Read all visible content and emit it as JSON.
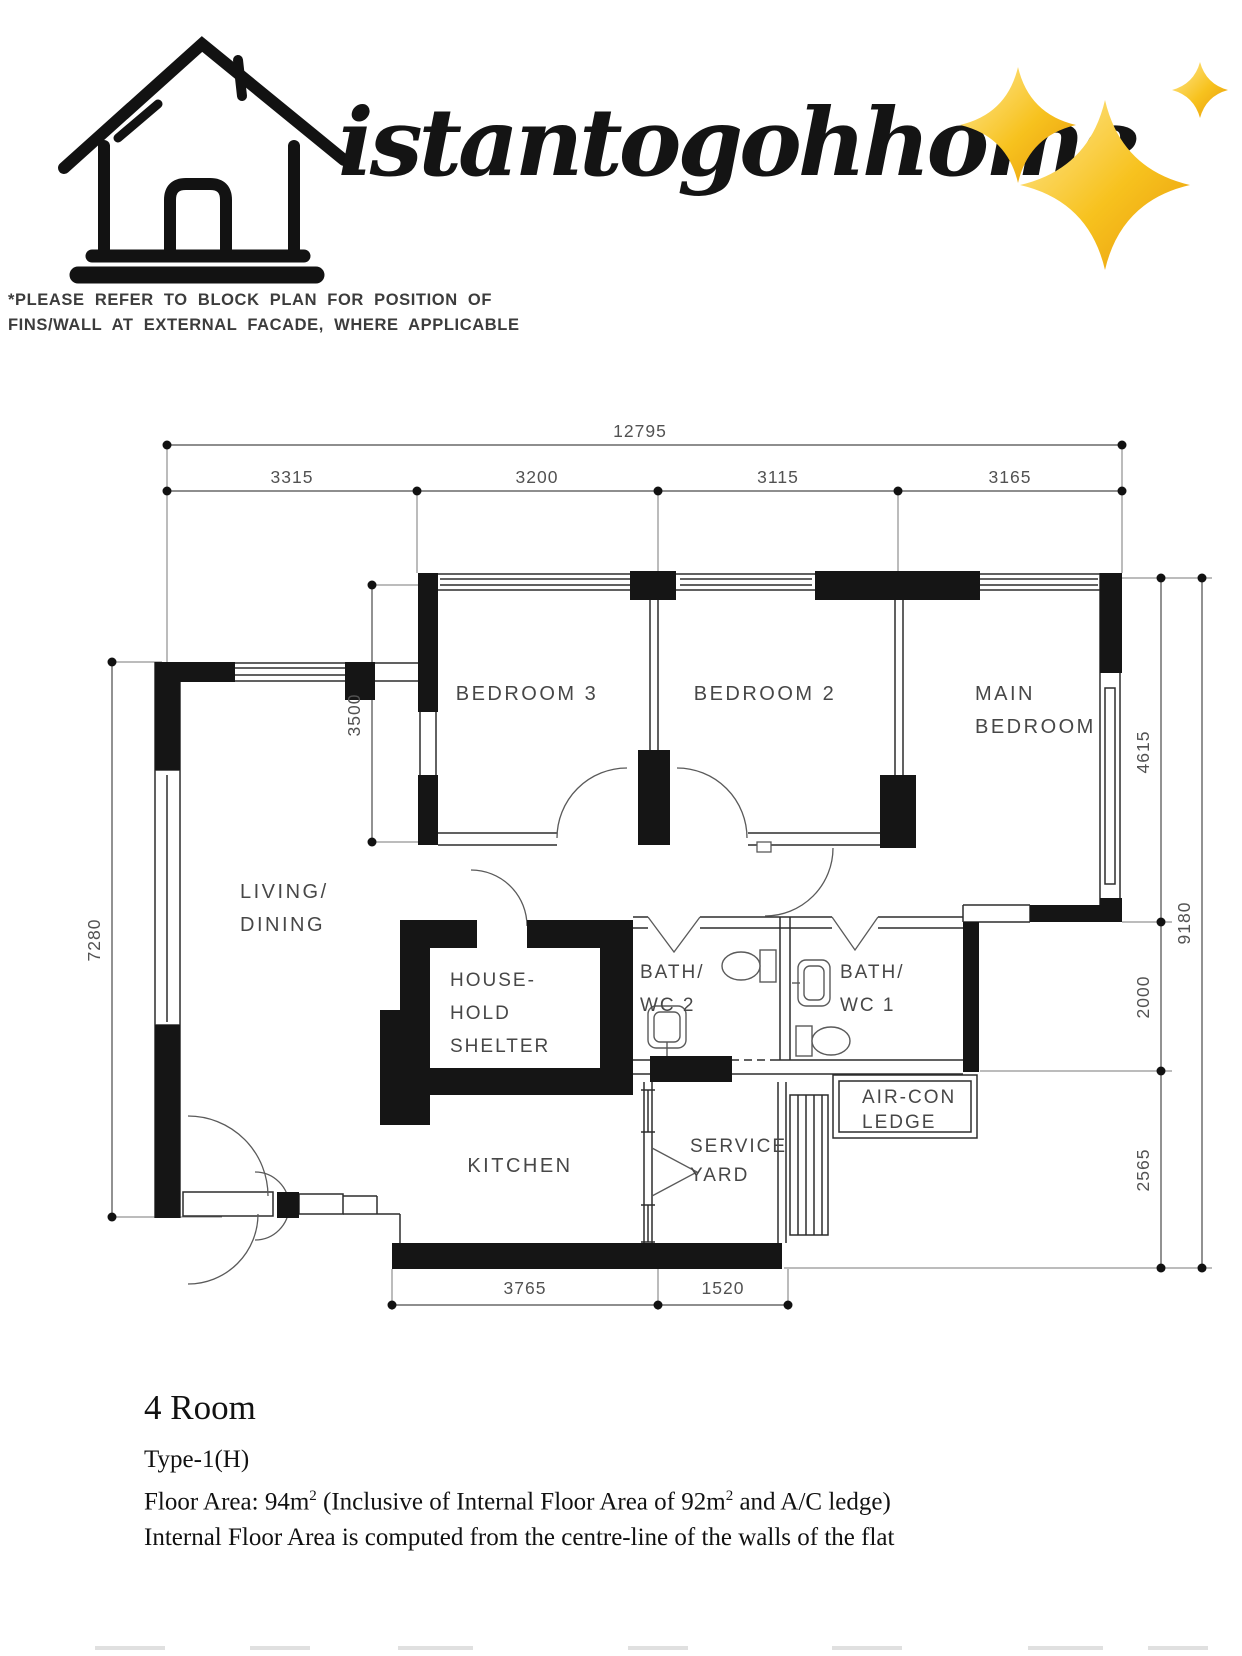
{
  "brand": {
    "name": "istantogohhome",
    "logo": "house-line-art-icon",
    "sparkles": "sparkles-icon",
    "accent_gold": "#F6B51E",
    "ink": "#141414"
  },
  "note": {
    "line1": "*PLEASE REFER TO BLOCK PLAN FOR POSITION OF",
    "line2": "FINS/WALL AT EXTERNAL FACADE, WHERE APPLICABLE"
  },
  "plan": {
    "rooms": {
      "bedroom3": "BEDROOM 3",
      "bedroom2": "BEDROOM 2",
      "main_bedroom_line1": "MAIN",
      "main_bedroom_line2": "BEDROOM",
      "living_line1": "LIVING/",
      "living_line2": "DINING",
      "shelter_line1": "HOUSE-",
      "shelter_line2": "HOLD",
      "shelter_line3": "SHELTER",
      "bath2_line1": "BATH/",
      "bath2_line2": "WC 2",
      "bath1_line1": "BATH/",
      "bath1_line2": "WC 1",
      "aircon_line1": "AIR-CON",
      "aircon_line2": "LEDGE",
      "kitchen": "KITCHEN",
      "service_yard_line1": "SERVICE",
      "service_yard_line2": "YARD"
    },
    "dimensions": {
      "overall_width": "12795",
      "seg1": "3315",
      "seg2": "3200",
      "seg3": "3115",
      "seg4": "3165",
      "left_height": "7280",
      "bed3_depth": "3500",
      "right_seg1": "4615",
      "right_seg2": "2000",
      "right_seg3": "2565",
      "overall_height": "9180",
      "bottom_seg1": "3765",
      "bottom_seg2": "1520"
    }
  },
  "summary": {
    "title": "4 Room",
    "type": "Type-1(H)",
    "floor_area_prefix": "Floor Area: 94m",
    "floor_area_sup1": "2",
    "floor_area_mid": " (Inclusive of Internal Floor Area of 92m",
    "floor_area_sup2": "2",
    "floor_area_suffix": " and A/C ledge)",
    "footnote": "Internal Floor Area is computed from the centre-line of the walls of the flat"
  }
}
